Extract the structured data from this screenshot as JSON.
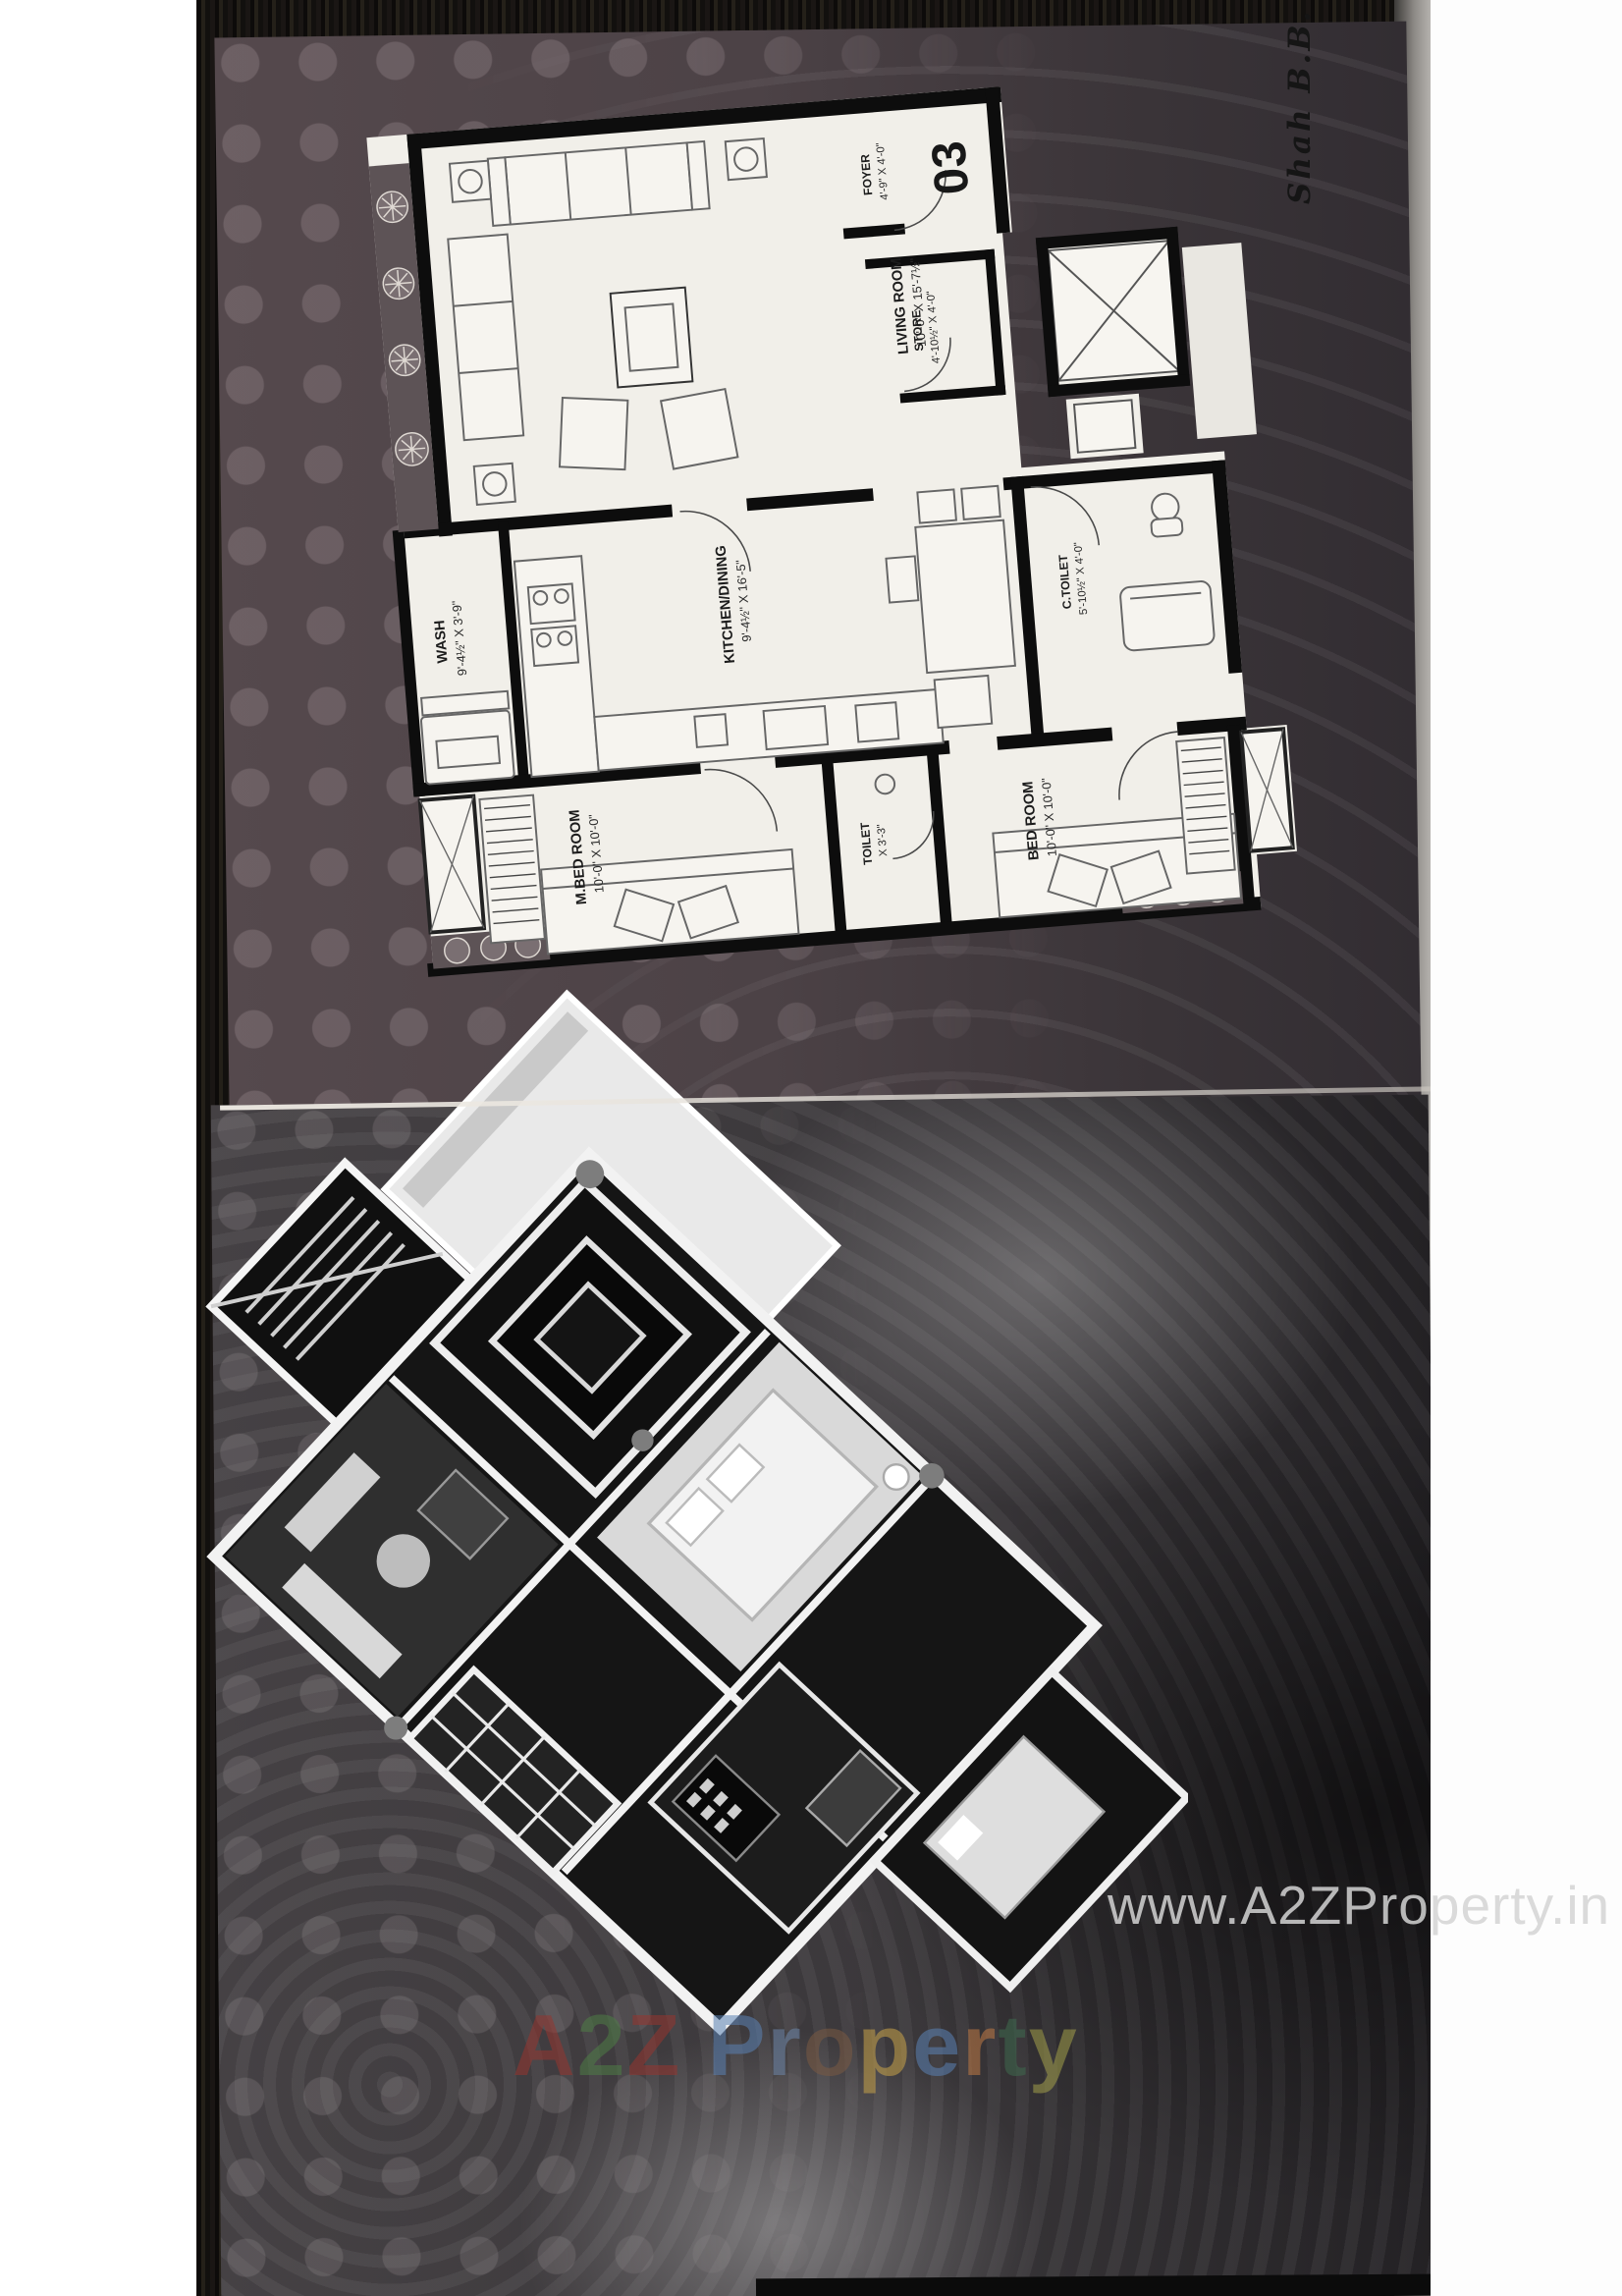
{
  "photo": {
    "handwriting_note": "Shah B.B.",
    "unit_number": "03",
    "watermark_url": "www.A2ZProperty.in",
    "brand_watermark": {
      "text": "A2Z Property",
      "letters": [
        {
          "ch": "A",
          "color": "#96352f"
        },
        {
          "ch": "2",
          "color": "#4e7d46"
        },
        {
          "ch": "Z",
          "color": "#96352f"
        },
        {
          "ch": " ",
          "color": "#888888"
        },
        {
          "ch": "P",
          "color": "#5b82b4"
        },
        {
          "ch": "r",
          "color": "#6f88ab"
        },
        {
          "ch": "o",
          "color": "#7a5a43"
        },
        {
          "ch": "p",
          "color": "#c9a44a"
        },
        {
          "ch": "e",
          "color": "#5b82b4"
        },
        {
          "ch": "r",
          "color": "#c07a45"
        },
        {
          "ch": "t",
          "color": "#3f6b4f"
        },
        {
          "ch": "y",
          "color": "#a3a04b"
        }
      ]
    },
    "floor_plan": {
      "rooms": [
        {
          "id": "living",
          "name": "LIVING ROOM",
          "dim": "10'-0\" X 15'-7½\""
        },
        {
          "id": "foyer",
          "name": "FOYER",
          "dim": "4'-9\" X 4'-0\""
        },
        {
          "id": "store",
          "name": "STORE",
          "dim": "4'-10½\" X 4'-0\""
        },
        {
          "id": "wash",
          "name": "WASH",
          "dim": "9'-4½\" X 3'-9\""
        },
        {
          "id": "kitchen",
          "name": "KITCHEN/DINING",
          "dim": "9'-4½\" X 16'-5\""
        },
        {
          "id": "ctoilet",
          "name": "C.TOILET",
          "dim": "5'-10½\" X 4'-0\""
        },
        {
          "id": "mbed",
          "name": "M.BED ROOM",
          "dim": "10'-0\" X 10'-0\""
        },
        {
          "id": "toilet",
          "name": "TOILET",
          "dim": "X 3'-3\""
        },
        {
          "id": "bed",
          "name": "BED ROOM",
          "dim": "10'-0\" X 10'-0\""
        }
      ]
    },
    "colors": {
      "page_top": "#4c4246",
      "page_bottom": "#3b383b",
      "plan_paper": "#f1efe9",
      "plan_walls": "#0d0d0d",
      "watermark_gray": "#d4d4d4"
    }
  }
}
